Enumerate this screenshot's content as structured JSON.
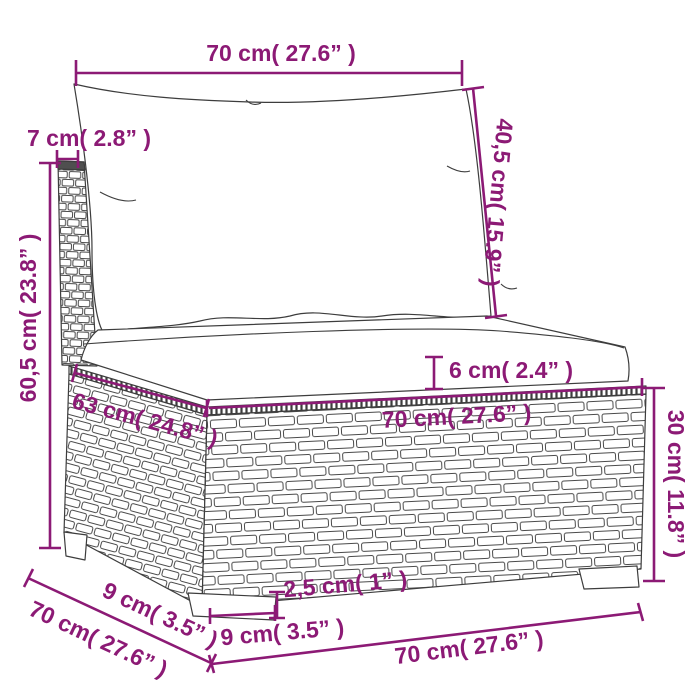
{
  "title": "Garden sofa middle section dimension diagram",
  "colors": {
    "dimension": "#8c1a75",
    "line_art": "#3d3d3d",
    "weave": "#4a4a4a",
    "background": "#ffffff"
  },
  "labels": {
    "top_width": "70 cm( 27.6” )",
    "post_width": "7 cm( 2.8” )",
    "back_cushion_height": "40,5 cm( 15.9” )",
    "total_height": "60,5 cm( 23.8” )",
    "cushion_thickness": "6 cm( 2.4” )",
    "seat_depth": "63 cm( 24.8” )",
    "seat_width": "70 cm( 27.6” )",
    "base_height": "30 cm( 11.8” )",
    "side_depth_upper": "9 cm( 3.5” )",
    "side_depth_total": "70 cm( 27.6” )",
    "foot_width": "9 cm( 3.5” )",
    "foot_height": "2,5 cm( 1” )",
    "bottom_width": "70 cm( 27.6” )"
  }
}
